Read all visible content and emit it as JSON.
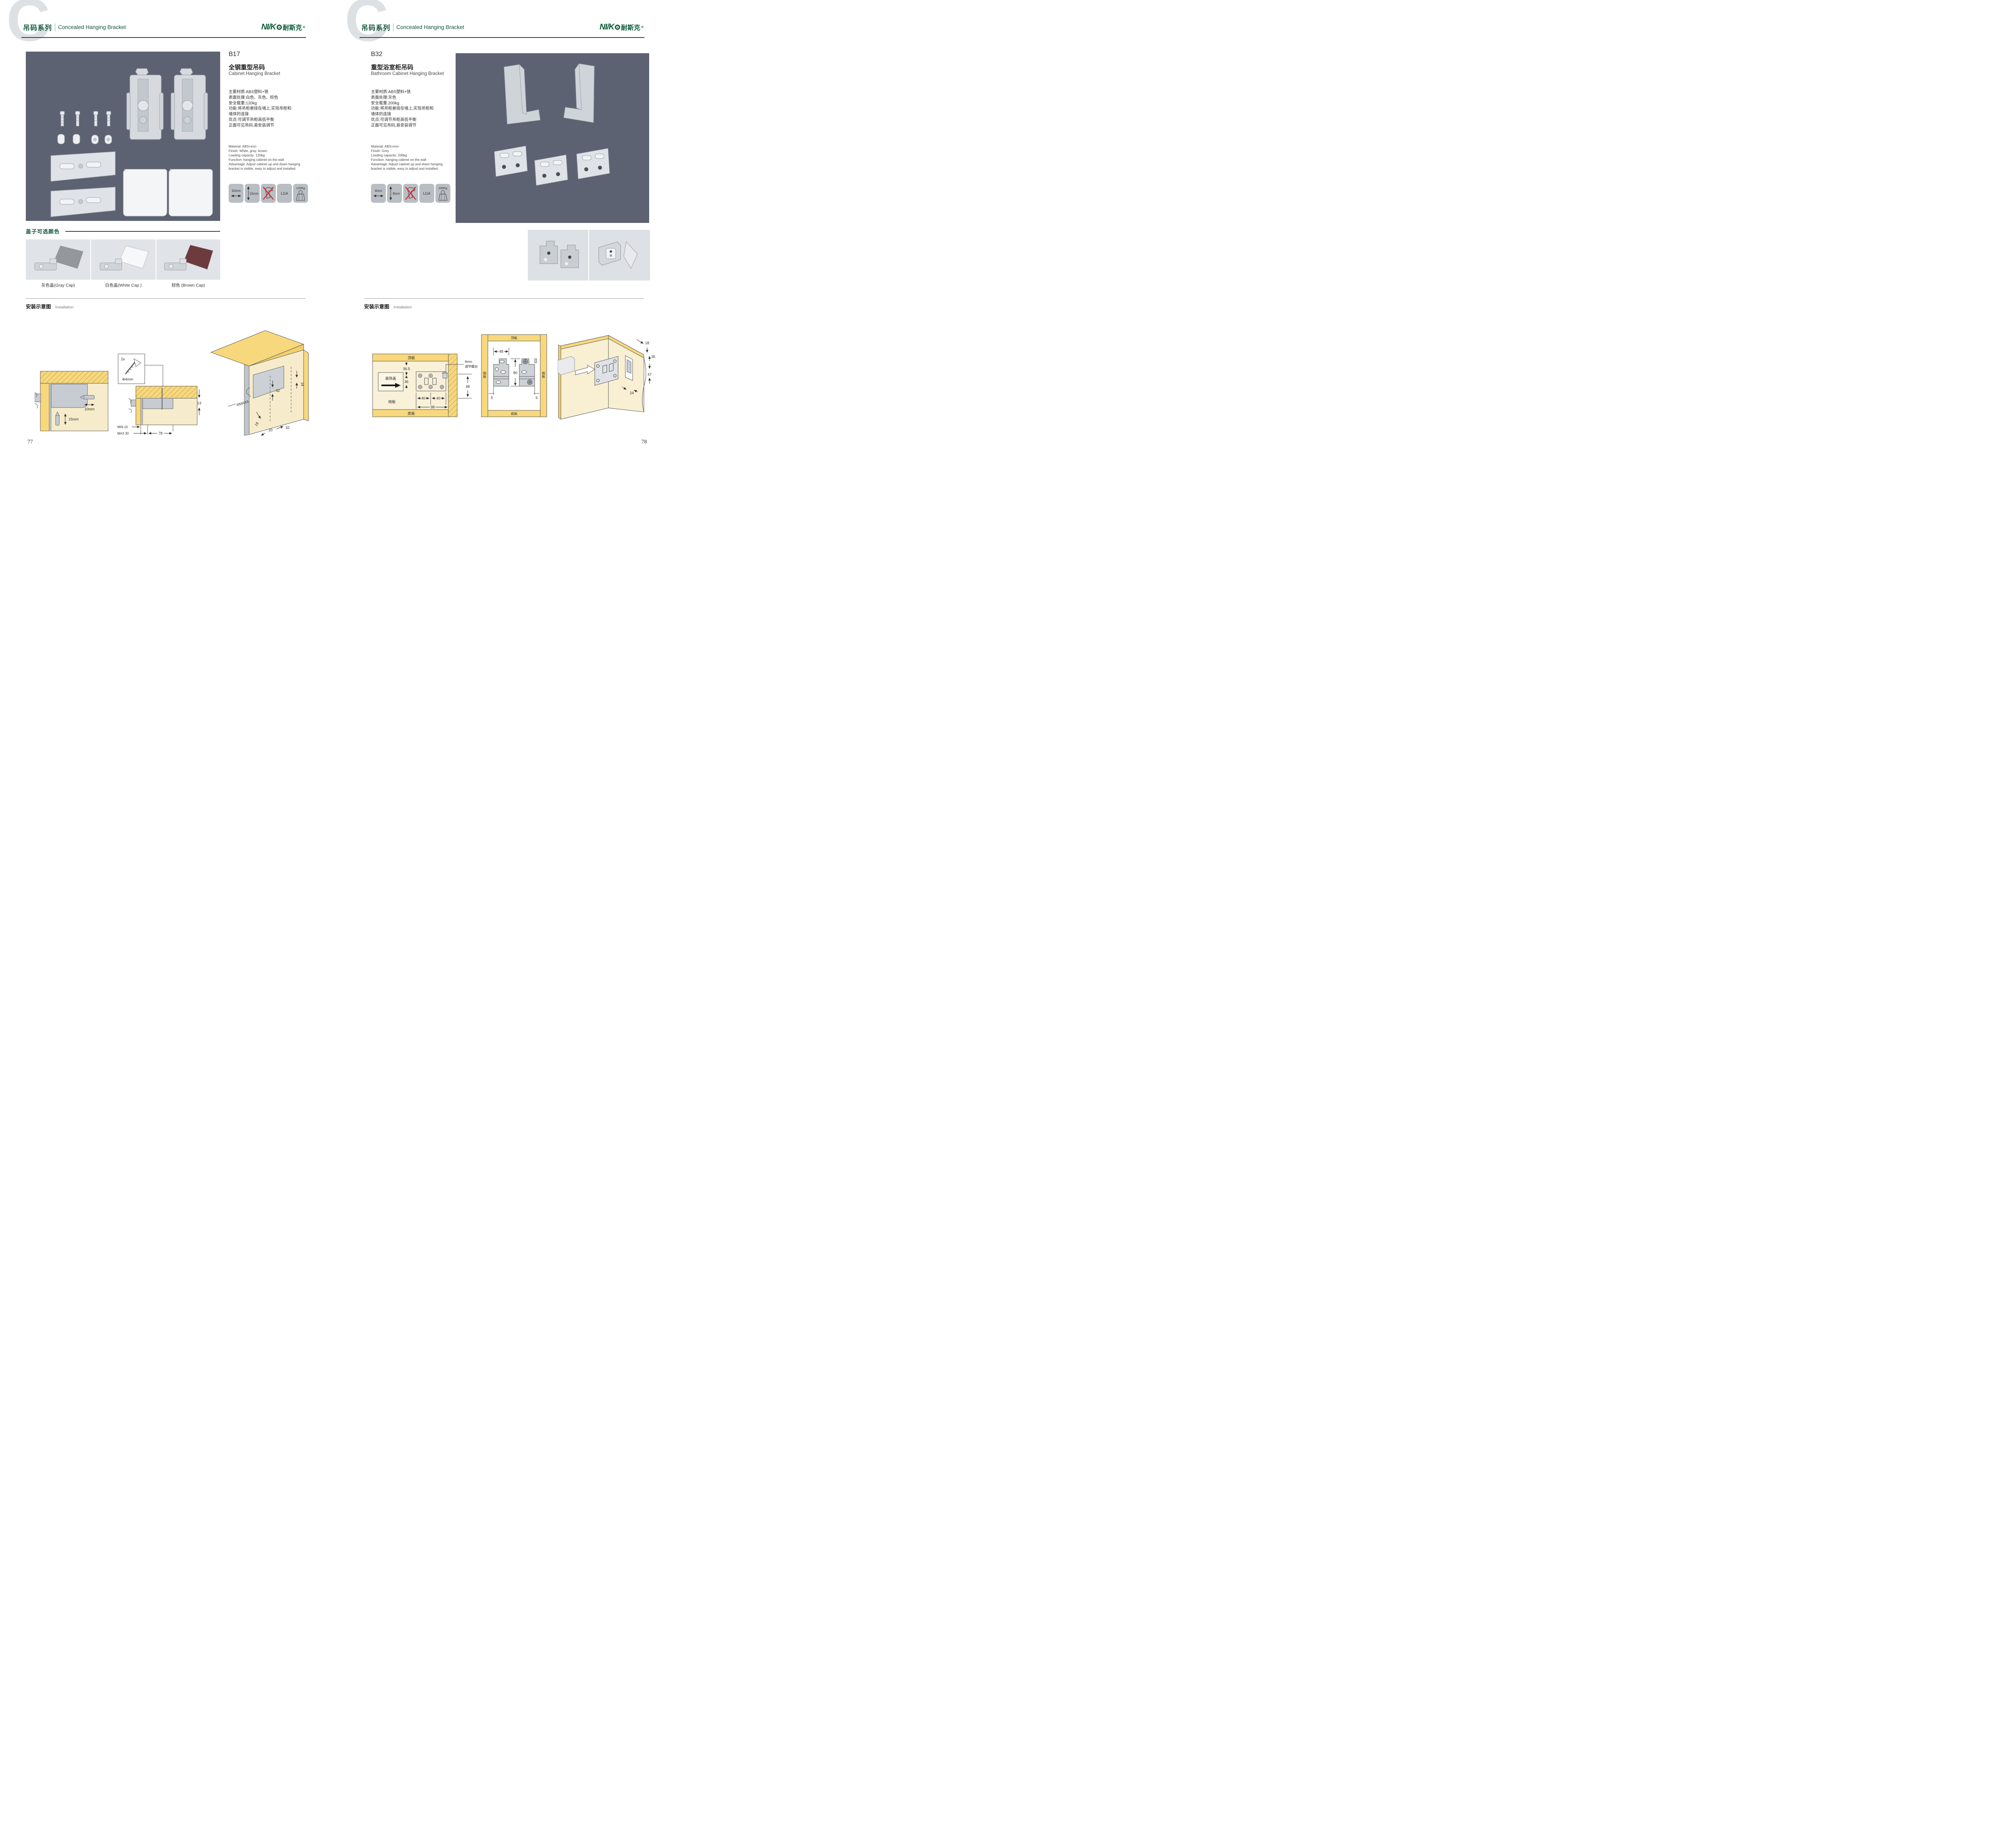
{
  "header": {
    "watermark_letter": "C",
    "series_cn": "吊码系列",
    "series_en": "Concealed Hanging Bracket",
    "logo_text": "NI/K",
    "logo_cn": "耐斯克",
    "logo_reg": "®"
  },
  "left_page": {
    "page_number": "77",
    "product": {
      "code": "B17",
      "name_cn": "全钢重型吊码",
      "name_en": "Cabinet Hanging Bracket",
      "specs_cn": [
        "主要材质:ABS塑料+铁",
        "表面处理:白色、灰色、棕色",
        "安全载重:120kg",
        "功能:将吊柜悬挂在墙上,实现吊柜和",
        "墙体的连接",
        "优点:可调节吊柜高低平衡",
        "正面可见吊码,易安装调节"
      ],
      "specs_en": [
        "Material: ABS+iron",
        "Finish: White, gray, brown",
        "Loading capacity: 120kg",
        "Function: hanging cabinet on the wall",
        "Advantage: Adjust cabinet up and down hanging",
        "bracket is visible, easy to adjust and installed"
      ],
      "badge_h_arrow": "10mm",
      "badge_v_arrow": "15mm",
      "badge_cert": "LGA",
      "badge_load": "120Kg"
    },
    "cap_section": {
      "title": "盖子可选颜色",
      "caps": [
        {
          "label": "灰色盖(Gray Cap)",
          "color": "#94979c"
        },
        {
          "label": "白色盖(White Cap )",
          "color": "#f7f8f9"
        },
        {
          "label": "棕色 (Brown Cap)",
          "color": "#6d3b3e"
        }
      ]
    },
    "installation": {
      "title_cn": "安装示意图",
      "title_en": "Installation",
      "d1": {
        "dim_h": "10mm",
        "dim_v": "15mm"
      },
      "d2": {
        "qty": "2x",
        "dia": "Φ4mm",
        "t": "13",
        "min": "MIN.10",
        "max": "MAX.30",
        "depth": "78"
      },
      "d3": {
        "top": "34",
        "v": "32",
        "r": "RMAX4",
        "a": "18",
        "b": "20",
        "c": "32"
      }
    }
  },
  "right_page": {
    "page_number": "78",
    "product": {
      "code": "B32",
      "name_cn": "重型浴室柜吊码",
      "name_en": "Bathroom Cabinet Hanging Bracket",
      "specs_cn": [
        "主要材质:ABS塑料+铁",
        "表面处理:灰色",
        "安全载重:200kg",
        "功能:将吊柜悬挂在墙上,实现吊柜和",
        "墙体的连接",
        "优点:可调节吊柜高低平衡",
        "正面可见吊码,易安装调节"
      ],
      "specs_en": [
        "Material: ABS+iron",
        "Finish: Grey",
        "Loading capacity: 200kg",
        "Function: hanging cabinet on the wall",
        "Advantage: Adjust cabinet up and down hanging",
        "bracket is visible, easy to adjust and installed"
      ],
      "badge_h_arrow": "4mm",
      "badge_v_arrow": "8mm",
      "badge_cert": "LGA",
      "badge_load": "200Kg"
    },
    "installation": {
      "title_cn": "安装示意图",
      "title_en": "Installation",
      "d1": {
        "top_board": "顶板",
        "deco_cap": "装饰盖",
        "side_board": "侧板",
        "bottom_board": "底板",
        "dim1": "36.5",
        "dim2": "36",
        "dim3": "40",
        "dim4": "40",
        "dim5": "98",
        "screw_note1": "8mm",
        "screw_note2": "调节螺丝",
        "dim6": "48"
      },
      "d2": {
        "top_board": "顶板",
        "bottom_board": "底板",
        "side_left": "侧板",
        "side_right": "侧板",
        "dim_w": "48",
        "dim_h": "80",
        "dim_off_l": "5",
        "dim_off_r": "5"
      },
      "d3": {
        "dim1": "18",
        "dim2": "35",
        "dim3": "47",
        "dim4": "24"
      }
    }
  }
}
